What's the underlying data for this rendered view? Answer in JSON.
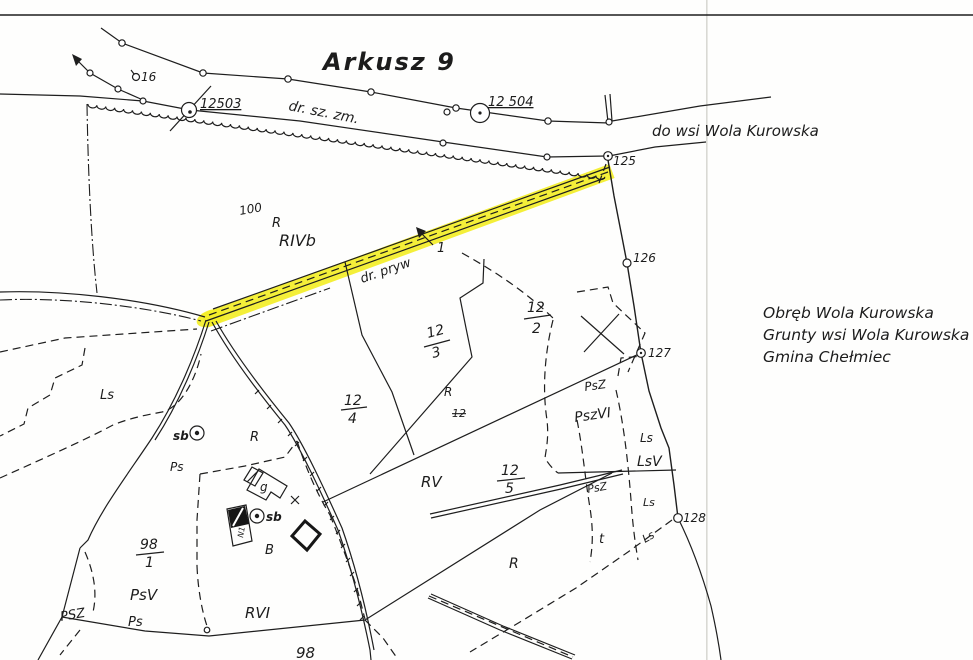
{
  "map": {
    "sheet_title": "Arkusz 9",
    "annotation_block": [
      "Obręb Wola Kurowska",
      "Grunty wsi Wola Kurowska",
      "Gmina Chełmiec"
    ],
    "colors": {
      "highlight": "#f3ee28",
      "ink": "#1e1e1e",
      "fold_line": "#d9d9d4"
    },
    "highlighted_road_label": "dr. pryw",
    "labels": [
      {
        "id": "sheet-title",
        "text": "Arkusz 9",
        "x": 323,
        "y": 70,
        "size": 24,
        "rot": 0,
        "cls": "t"
      },
      {
        "id": "point-16",
        "text": "16",
        "x": 141,
        "y": 81,
        "size": 12,
        "rot": 0
      },
      {
        "id": "point-12503",
        "text": "12503",
        "x": 200,
        "y": 108,
        "size": 13,
        "rot": 0,
        "cls": "u"
      },
      {
        "id": "road-dr-sz-zm",
        "text": "dr. sz. zm.",
        "x": 288,
        "y": 110,
        "size": 14,
        "rot": 11
      },
      {
        "id": "point-12504",
        "text": "12 504",
        "x": 488,
        "y": 106,
        "size": 13,
        "rot": 0,
        "cls": "u"
      },
      {
        "id": "road-do-wsi",
        "text": "do wsi Wola Kurowska",
        "x": 652,
        "y": 136,
        "size": 15,
        "rot": 0
      },
      {
        "id": "point-125",
        "text": "125",
        "x": 613,
        "y": 165,
        "size": 12,
        "rot": 0
      },
      {
        "id": "parcel-100",
        "text": "100",
        "x": 240,
        "y": 215,
        "size": 12,
        "rot": -10
      },
      {
        "id": "landuse-r-top",
        "text": "R",
        "x": 272,
        "y": 227,
        "size": 13,
        "rot": 0
      },
      {
        "id": "landuse-rivb",
        "text": "RIVb",
        "x": 279,
        "y": 246,
        "size": 16,
        "rot": 0
      },
      {
        "id": "road-dr-pryw",
        "text": "dr. pryw",
        "x": 362,
        "y": 283,
        "size": 13,
        "rot": -19
      },
      {
        "id": "parcel-1-arrow",
        "text": "1",
        "x": 437,
        "y": 252,
        "size": 13,
        "rot": 0
      },
      {
        "id": "point-126",
        "text": "126",
        "x": 633,
        "y": 262,
        "size": 12,
        "rot": 0
      },
      {
        "id": "parcel-12-2-num",
        "text": "12",
        "x": 527,
        "y": 312,
        "size": 14,
        "rot": 0
      },
      {
        "id": "parcel-12-2-den",
        "text": "2",
        "x": 532,
        "y": 333,
        "size": 14,
        "rot": 0
      },
      {
        "id": "parcel-12-3-num",
        "text": "12",
        "x": 428,
        "y": 338,
        "size": 14,
        "rot": -15
      },
      {
        "id": "parcel-12-3-den",
        "text": "3",
        "x": 433,
        "y": 358,
        "size": 14,
        "rot": -15
      },
      {
        "id": "point-127",
        "text": "127",
        "x": 648,
        "y": 357,
        "size": 12,
        "rot": 0
      },
      {
        "id": "note-line-1",
        "text": "Obręb Wola Kurowska",
        "x": 763,
        "y": 318,
        "size": 15.5,
        "rot": 0
      },
      {
        "id": "note-line-2",
        "text": "Grunty wsi Wola Kurowska",
        "x": 763,
        "y": 340,
        "size": 15.5,
        "rot": 0
      },
      {
        "id": "note-line-3",
        "text": "Gmina Chełmiec",
        "x": 763,
        "y": 362,
        "size": 15.5,
        "rot": 0
      },
      {
        "id": "landuse-ls-west",
        "text": "Ls",
        "x": 100,
        "y": 399,
        "size": 13,
        "rot": 0
      },
      {
        "id": "landuse-psz-a",
        "text": "PsZ",
        "x": 585,
        "y": 391,
        "size": 12,
        "rot": -8
      },
      {
        "id": "landuse-pszvi",
        "text": "PszVI",
        "x": 575,
        "y": 422,
        "size": 14,
        "rot": -8
      },
      {
        "id": "landuse-r-mid",
        "text": "R",
        "x": 444,
        "y": 396,
        "size": 12,
        "rot": 0
      },
      {
        "id": "parcel-12-4-num",
        "text": "12",
        "x": 344,
        "y": 405,
        "size": 14,
        "rot": 0
      },
      {
        "id": "parcel-12-4-den",
        "text": "4",
        "x": 348,
        "y": 423,
        "size": 14,
        "rot": 0
      },
      {
        "id": "parcel-12-struck",
        "text": "12",
        "x": 452,
        "y": 417,
        "size": 11,
        "rot": 0,
        "cls": "s"
      },
      {
        "id": "landuse-ls-e1",
        "text": "Ls",
        "x": 640,
        "y": 442,
        "size": 12,
        "rot": 0
      },
      {
        "id": "landuse-lsv",
        "text": "LsV",
        "x": 637,
        "y": 466,
        "size": 14,
        "rot": 0
      },
      {
        "id": "well-sb-1",
        "text": "sb",
        "x": 173,
        "y": 440,
        "size": 12,
        "rot": 0,
        "cls": "b"
      },
      {
        "id": "landuse-r-farm",
        "text": "R",
        "x": 250,
        "y": 441,
        "size": 13,
        "rot": 0
      },
      {
        "id": "landuse-ps-a",
        "text": "Ps",
        "x": 170,
        "y": 471,
        "size": 12,
        "rot": 0
      },
      {
        "id": "building-g-label",
        "text": "g",
        "x": 260,
        "y": 491,
        "size": 12,
        "rot": 0
      },
      {
        "id": "landuse-rv",
        "text": "RV",
        "x": 421,
        "y": 487,
        "size": 15,
        "rot": 0
      },
      {
        "id": "parcel-12-5-num",
        "text": "12",
        "x": 501,
        "y": 475,
        "size": 14,
        "rot": 0
      },
      {
        "id": "parcel-12-5-den",
        "text": "5",
        "x": 505,
        "y": 493,
        "size": 14,
        "rot": 0
      },
      {
        "id": "landuse-psz-b",
        "text": "PsZ",
        "x": 588,
        "y": 493,
        "size": 11,
        "rot": -10
      },
      {
        "id": "landuse-ls-e2",
        "text": "Ls",
        "x": 643,
        "y": 506,
        "size": 11,
        "rot": 0
      },
      {
        "id": "well-sb-2",
        "text": "sb",
        "x": 266,
        "y": 521,
        "size": 12,
        "rot": 0,
        "cls": "b"
      },
      {
        "id": "building-n1-label",
        "text": "N1",
        "x": 243,
        "y": 538,
        "size": 8,
        "rot": -80
      },
      {
        "id": "parcel-98-1-num",
        "text": "98",
        "x": 140,
        "y": 549,
        "size": 14,
        "rot": 0
      },
      {
        "id": "parcel-98-1-den",
        "text": "1",
        "x": 145,
        "y": 567,
        "size": 14,
        "rot": 0
      },
      {
        "id": "landuse-b",
        "text": "B",
        "x": 265,
        "y": 554,
        "size": 13,
        "rot": 0
      },
      {
        "id": "point-128",
        "text": "128",
        "x": 683,
        "y": 522,
        "size": 12,
        "rot": 0
      },
      {
        "id": "landuse-t",
        "text": "t",
        "x": 599,
        "y": 543,
        "size": 13,
        "rot": 0
      },
      {
        "id": "landuse-ls-road",
        "text": "Ls",
        "x": 645,
        "y": 543,
        "size": 11,
        "rot": -30
      },
      {
        "id": "landuse-psv",
        "text": "PsV",
        "x": 130,
        "y": 600,
        "size": 15,
        "rot": 0
      },
      {
        "id": "landuse-psz-c",
        "text": "PSZ",
        "x": 61,
        "y": 621,
        "size": 13,
        "rot": -10
      },
      {
        "id": "landuse-ps-b",
        "text": "Ps",
        "x": 128,
        "y": 626,
        "size": 13,
        "rot": 0
      },
      {
        "id": "landuse-rvi",
        "text": "RVI",
        "x": 245,
        "y": 618,
        "size": 15,
        "rot": 0
      },
      {
        "id": "parcel-98",
        "text": "98",
        "x": 296,
        "y": 658,
        "size": 15,
        "rot": 0
      },
      {
        "id": "landuse-r-south",
        "text": "R",
        "x": 509,
        "y": 568,
        "size": 14,
        "rot": 0
      }
    ]
  }
}
